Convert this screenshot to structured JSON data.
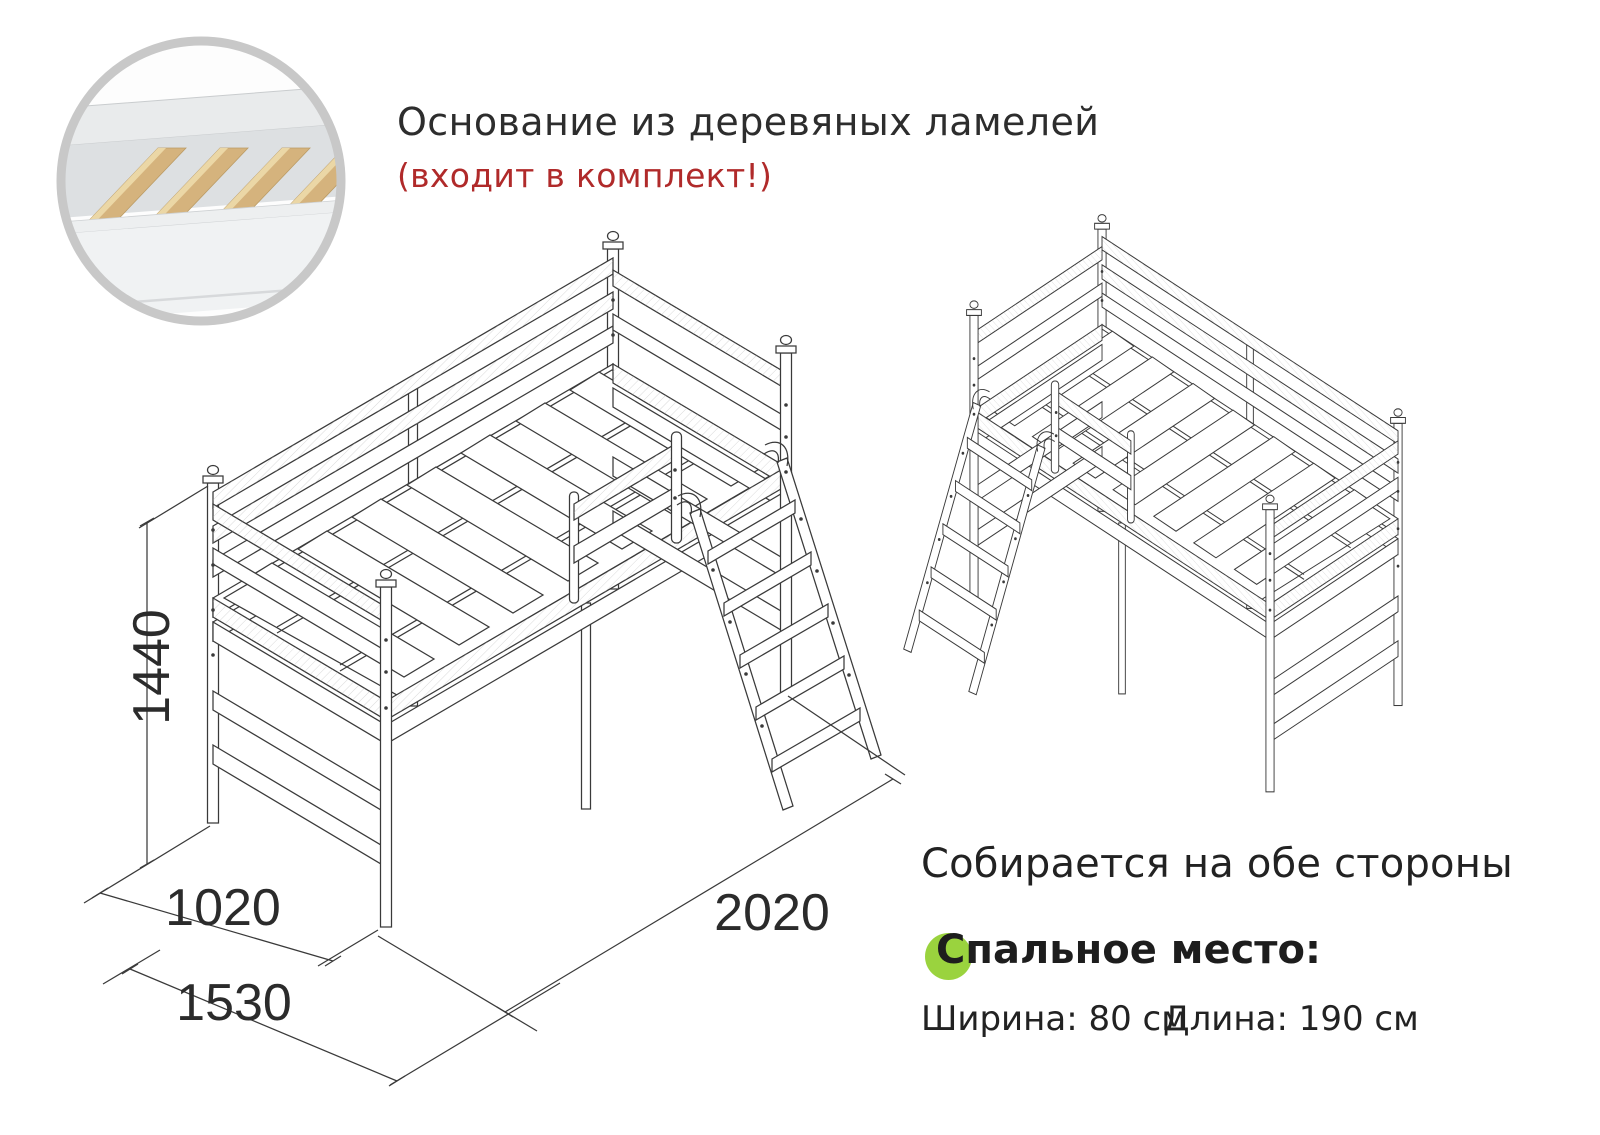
{
  "header": {
    "title": "Основание из деревяных ламелей",
    "subtitle_red": "(входит в комплект!)"
  },
  "drawing": {
    "dim_height_mm": "1440",
    "dim_width_mm": "1020",
    "dim_total_width_mm": "1530",
    "dim_length_mm": "2020"
  },
  "right_panel": {
    "assemble_note": "Собирается на обе стороны",
    "sleeping_place_label": "Спальное место:",
    "sleeping_width": "Ширина: 80 см",
    "sleeping_length": "Длина: 190 см"
  },
  "colors": {
    "accent_green": "#9ad33e",
    "accent_red": "#b02a2a",
    "line_color": "#3a3a3a",
    "text_color": "#2d2d2d",
    "wood": "#d5b37d",
    "ring_gray": "#c8c8c8"
  }
}
